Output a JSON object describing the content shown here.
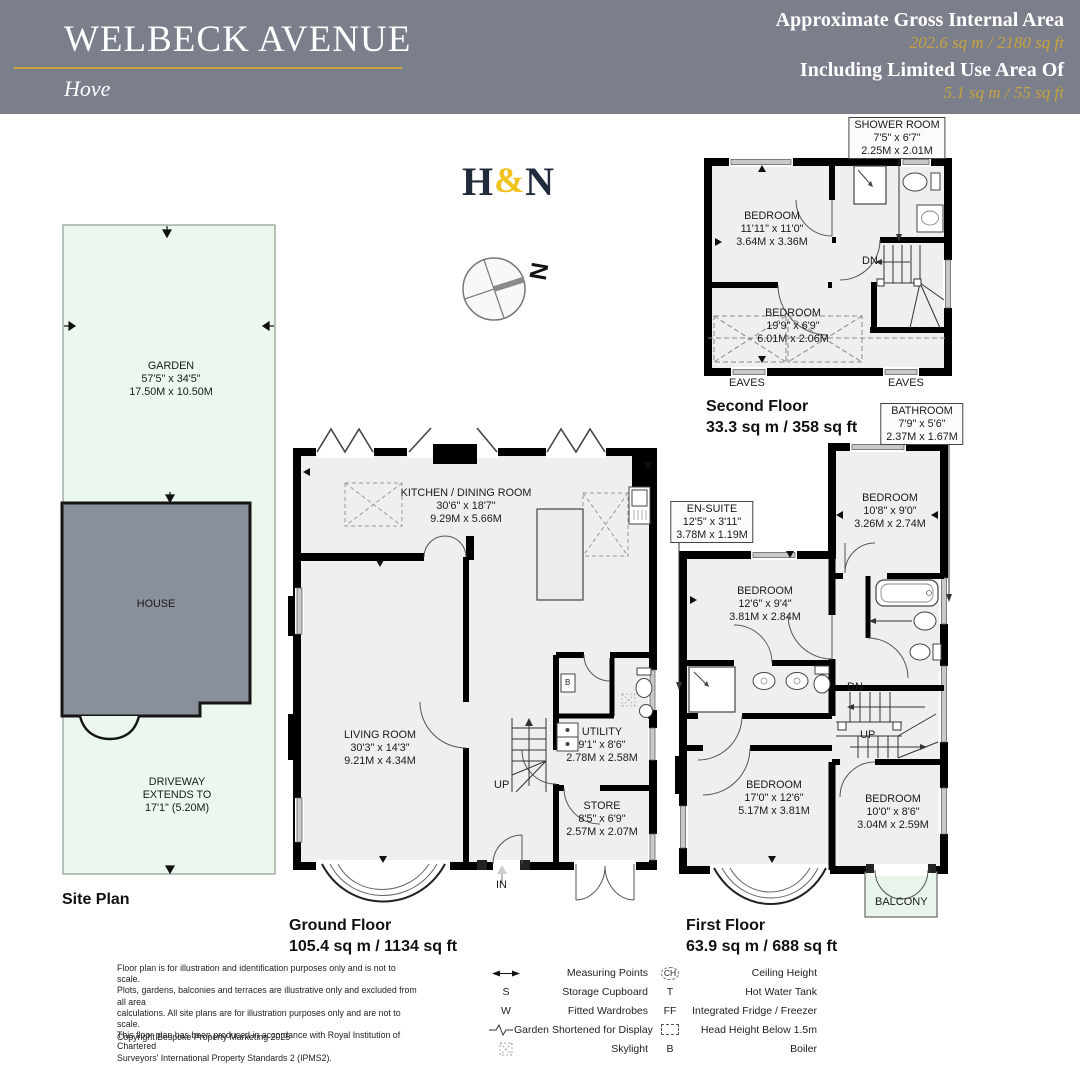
{
  "header": {
    "bg": "#7b7f8b",
    "gold": "#c7a23f",
    "title": "WELBECK AVENUE",
    "town": "Hove",
    "area_label": "Approximate Gross Internal Area",
    "area_value": "202.6 sq m / 2180 sq ft",
    "limited_label": "Including Limited Use Area Of",
    "limited_value": "5.1 sq m / 55 sq ft"
  },
  "logo": {
    "p1": "H",
    "amp": "&",
    "p2": "N",
    "navy": "#222b3e",
    "gold": "#f2c21e"
  },
  "compass": {
    "north": "N"
  },
  "site": {
    "title": "Site Plan",
    "garden": {
      "name": "GARDEN",
      "imp": "57'5\" x 34'5\"",
      "met": "17.50M x 10.50M"
    },
    "house": "HOUSE",
    "drive1": "DRIVEWAY",
    "drive2": "EXTENDS TO",
    "drive3": "17'1\" (5.20M)"
  },
  "gf": {
    "title": "Ground Floor",
    "area": "105.4 sq m / 1134 sq ft",
    "kitchen": {
      "name": "KITCHEN / DINING ROOM",
      "imp": "30'6\" x 18'7\"",
      "met": "9.29M x 5.66M"
    },
    "living": {
      "name": "LIVING ROOM",
      "imp": "30'3\" x 14'3\"",
      "met": "9.21M x 4.34M"
    },
    "utility": {
      "name": "UTILITY",
      "imp": "9'1\" x 8'6\"",
      "met": "2.78M x 2.58M"
    },
    "store": {
      "name": "STORE",
      "imp": "8'5\" x 6'9\"",
      "met": "2.57M x 2.07M"
    },
    "up": "UP",
    "entry": "IN",
    "boiler": "B"
  },
  "ff": {
    "title": "First Floor",
    "area": "63.9 sq m / 688 sq ft",
    "bathroom": {
      "name": "BATHROOM",
      "imp": "7'9\" x 5'6\"",
      "met": "2.37M x 1.67M"
    },
    "bedroom_rear": {
      "name": "BEDROOM",
      "imp": "10'8\" x 9'0\"",
      "met": "3.26M x 2.74M"
    },
    "ensuite": {
      "name": "EN-SUITE",
      "imp": "12'5\" x 3'11\"",
      "met": "3.78M x 1.19M"
    },
    "bedroom_mid": {
      "name": "BEDROOM",
      "imp": "12'6\" x 9'4\"",
      "met": "3.81M x 2.84M"
    },
    "bedroom_front": {
      "name": "BEDROOM",
      "imp": "17'0\" x 12'6\"",
      "met": "5.17M x 3.81M"
    },
    "bedroom_small": {
      "name": "BEDROOM",
      "imp": "10'0\" x 8'6\"",
      "met": "3.04M x 2.59M"
    },
    "balcony": "BALCONY",
    "dn": "DN",
    "up": "UP"
  },
  "sf": {
    "title": "Second Floor",
    "area": "33.3 sq m / 358 sq ft",
    "shower": {
      "name": "SHOWER ROOM",
      "imp": "7'5\" x 6'7\"",
      "met": "2.25M x 2.01M"
    },
    "bedroom_front": {
      "name": "BEDROOM",
      "imp": "11'11\" x 11'0\"",
      "met": "3.64M x 3.36M"
    },
    "bedroom_eaves": {
      "name": "BEDROOM",
      "imp": "19'9\" x 6'9\"",
      "met": "6.01M x 2.06M"
    },
    "dn": "DN",
    "eaves_l": "EAVES",
    "eaves_r": "EAVES"
  },
  "legend": {
    "disclaimer": "Floor plan is for illustration and identification purposes only and is not to scale.\nPlots, gardens, balconies and terraces are illustrative only and excluded from all area\ncalculations.  All site plans are for illustration purposes only and are not to scale.\nThis floor plan has been produced in accordance with Royal Institution of Chartered\nSurveyors' International Property Standards 2 (IPMS2).",
    "copyright": "Copyright Bespoke Property Marketing 2025",
    "col1": [
      {
        "sym": "",
        "label": "Measuring Points"
      },
      {
        "sym": "S",
        "label": "Storage Cupboard"
      },
      {
        "sym": "W",
        "label": "Fitted Wardrobes"
      },
      {
        "sym": "",
        "label": "Garden Shortened for Display"
      },
      {
        "sym": "",
        "label": "Skylight"
      }
    ],
    "col2": [
      {
        "sym": "CH",
        "label": "Ceiling Height"
      },
      {
        "sym": "T",
        "label": "Hot Water Tank"
      },
      {
        "sym": "FF",
        "label": "Integrated Fridge / Freezer"
      },
      {
        "sym": "",
        "label": "Head Height Below 1.5m"
      },
      {
        "sym": "B",
        "label": "Boiler"
      }
    ]
  }
}
